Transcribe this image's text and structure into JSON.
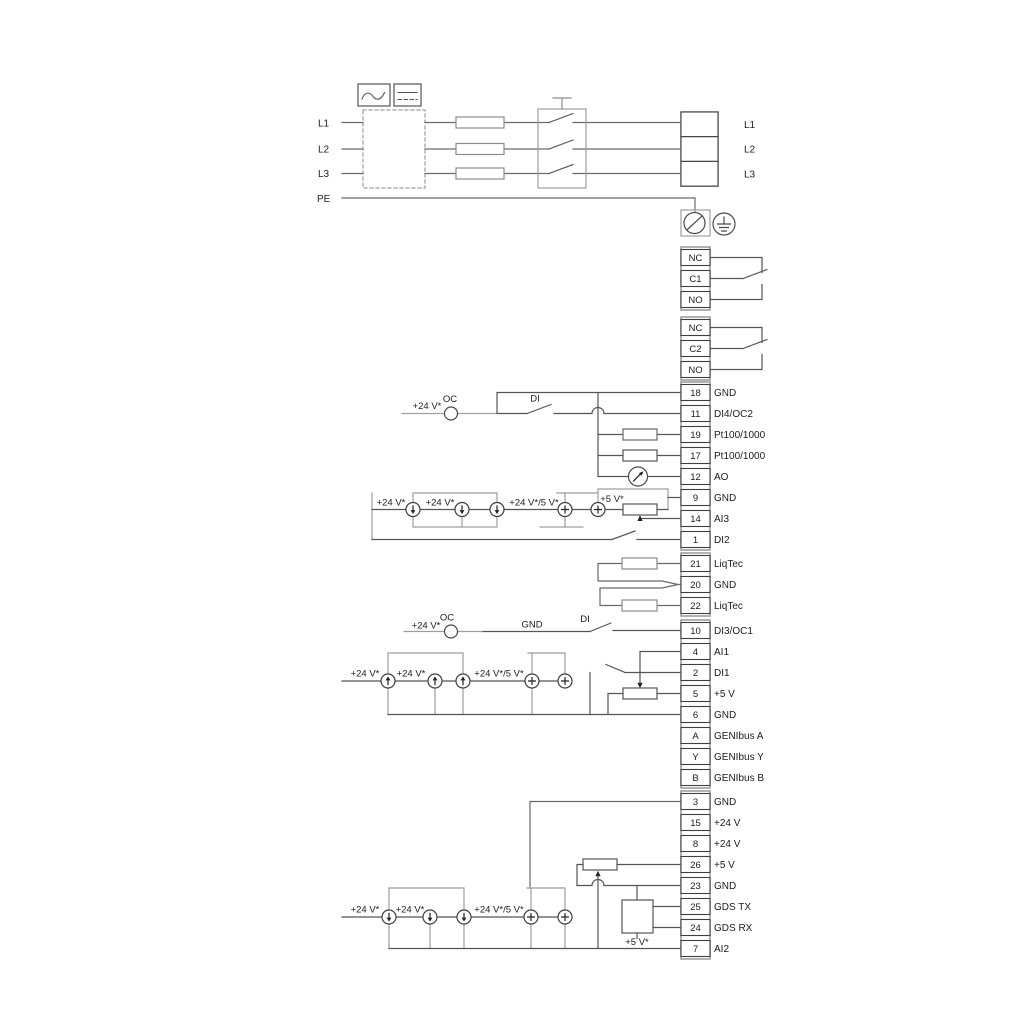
{
  "power": {
    "inputs": [
      "L1",
      "L2",
      "L3",
      "PE"
    ],
    "outputs": [
      "L1",
      "L2",
      "L3"
    ]
  },
  "relays": [
    {
      "terminals": [
        "NC",
        "C1",
        "NO"
      ]
    },
    {
      "terminals": [
        "NC",
        "C2",
        "NO"
      ]
    }
  ],
  "io": {
    "main": [
      {
        "num": "18",
        "label": "GND"
      },
      {
        "num": "11",
        "label": "DI4/OC2"
      },
      {
        "num": "19",
        "label": "Pt100/1000"
      },
      {
        "num": "17",
        "label": "Pt100/1000"
      },
      {
        "num": "12",
        "label": "AO"
      },
      {
        "num": "9",
        "label": "GND"
      },
      {
        "num": "14",
        "label": "AI3"
      },
      {
        "num": "1",
        "label": "DI2"
      }
    ],
    "liqtec": [
      {
        "num": "21",
        "label": "LiqTec"
      },
      {
        "num": "20",
        "label": "GND"
      },
      {
        "num": "22",
        "label": "LiqTec"
      }
    ],
    "mid": [
      {
        "num": "10",
        "label": "DI3/OC1"
      },
      {
        "num": "4",
        "label": "AI1"
      },
      {
        "num": "2",
        "label": "DI1"
      },
      {
        "num": "5",
        "label": "+5 V"
      },
      {
        "num": "6",
        "label": "GND"
      },
      {
        "num": "A",
        "label": "GENIbus A"
      },
      {
        "num": "Y",
        "label": "GENIbus Y"
      },
      {
        "num": "B",
        "label": "GENIbus B"
      }
    ],
    "bottom": [
      {
        "num": "3",
        "label": "GND"
      },
      {
        "num": "15",
        "label": "+24 V"
      },
      {
        "num": "8",
        "label": "+24 V"
      },
      {
        "num": "26",
        "label": "+5 V"
      },
      {
        "num": "23",
        "label": "GND"
      },
      {
        "num": "25",
        "label": "GDS TX"
      },
      {
        "num": "24",
        "label": "GDS RX"
      },
      {
        "num": "7",
        "label": "AI2"
      }
    ]
  },
  "wire_labels": {
    "di4": {
      "supply": "+24 V*",
      "oc": "OC",
      "di": "DI"
    },
    "ai3": {
      "l1": "+24 V*",
      "l2": "+24 V*",
      "l3": "+24 V*/5 V*",
      "l4": "+5 V*"
    },
    "di3": {
      "supply": "+24 V*",
      "oc": "OC",
      "gnd": "GND",
      "di": "DI"
    },
    "ai1": {
      "l1": "+24 V*",
      "l2": "+24 V*",
      "l3": "+24 V*/5 V*"
    },
    "ai2": {
      "l1": "+24 V*",
      "l2": "+24 V*",
      "l3": "+24 V*/5 V*",
      "l4": "+5 V*"
    }
  },
  "colors": {
    "wire": "#555555",
    "rail": "#9e9e9e",
    "outline": "#8c8c8c",
    "text": "#1c1c1c"
  }
}
